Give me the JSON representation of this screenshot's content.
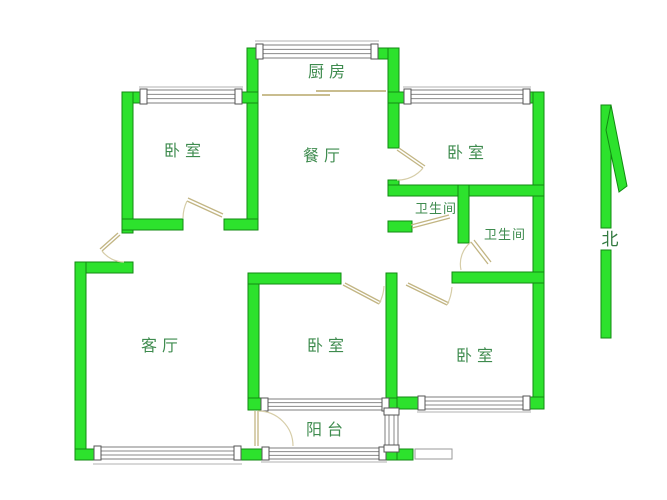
{
  "rooms": {
    "kitchen": {
      "label": "厨房"
    },
    "bedroom_top_left": {
      "label": "卧室"
    },
    "dining": {
      "label": "餐厅"
    },
    "bedroom_top_right": {
      "label": "卧室"
    },
    "bathroom_1": {
      "label": "卫生间"
    },
    "bathroom_2": {
      "label": "卫生间"
    },
    "living": {
      "label": "客厅"
    },
    "bedroom_bottom_middle": {
      "label": "卧室"
    },
    "bedroom_bottom_right": {
      "label": "卧室"
    },
    "balcony": {
      "label": "阳台"
    }
  },
  "compass": {
    "north_label": "北"
  },
  "colors": {
    "wall_fill": "#2de22d",
    "wall_stroke": "#128a12",
    "label_color": "#3e8b4e",
    "door_color": "#c2b583",
    "window_stroke": "#7d7d7d",
    "background": "#ffffff"
  }
}
